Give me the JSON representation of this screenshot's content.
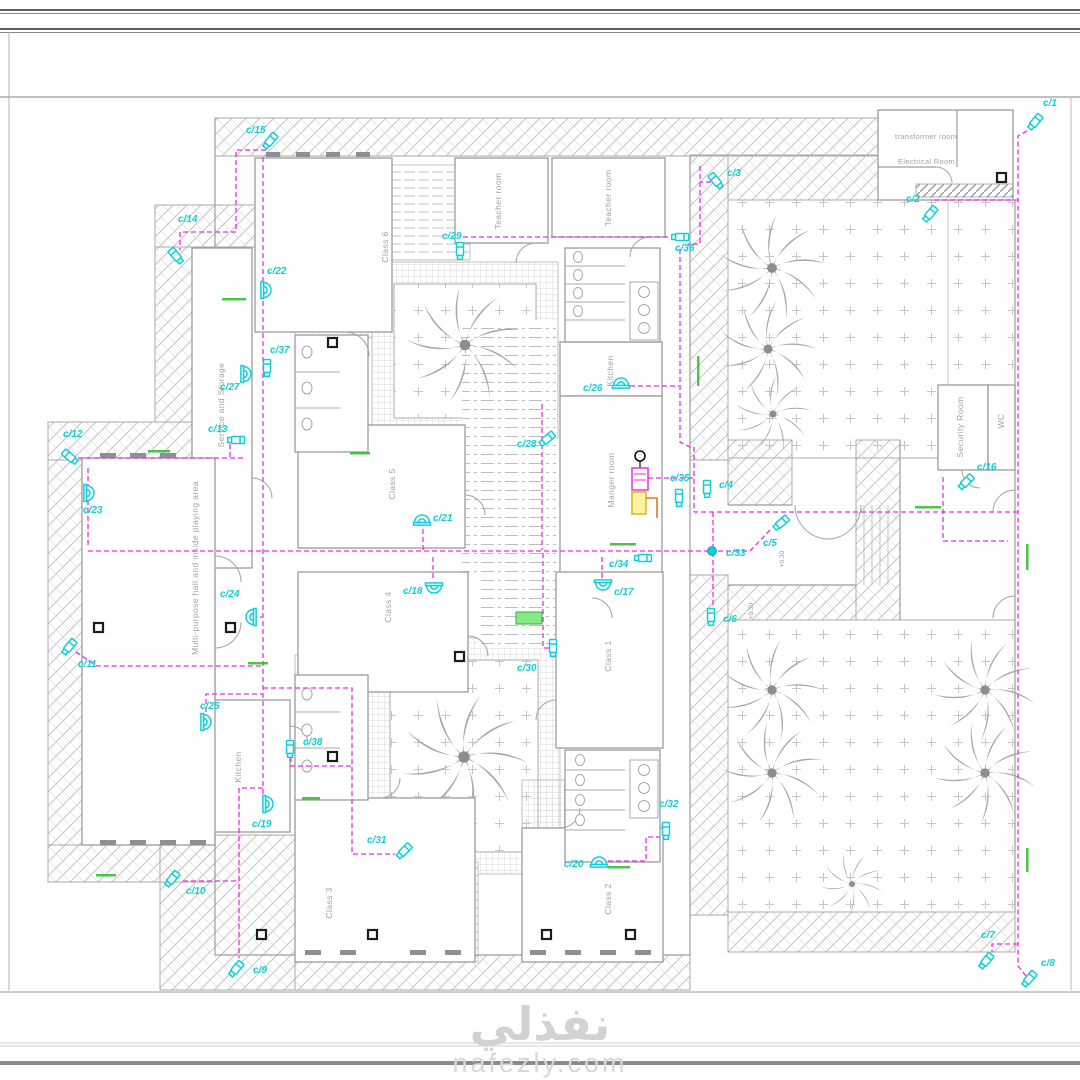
{
  "watermark": {
    "arabic": "نفذلي",
    "site": "nafezly.com"
  },
  "colors": {
    "wire": "#ee2bee",
    "camera": "#0fd0da",
    "green_tag": "#2eb82e",
    "wall": "#9c9c9c"
  },
  "levels": {
    "entrance_a": "+0.30",
    "entrance_b": "+0.30"
  },
  "rooms": {
    "transformer": "transformer room",
    "electrical": "Electrical Room",
    "class6": "Class 6",
    "teacher1": "Teacher room",
    "teacher2": "Teacher room",
    "service": "Service and Storage",
    "class5": "Class 5",
    "kitchen_top": "Kitchen",
    "manger": "Manger room",
    "class4": "Class 4",
    "class1": "Class 1",
    "class3": "Class 3",
    "class2": "Class 2",
    "kitchen_bottom": "Kitchen",
    "hall": "Multi-purpose hall and inside playing area",
    "security": "Security Room",
    "wc": "WC"
  },
  "cameras": [
    {
      "id": "c/1",
      "type": "b",
      "x": 1035,
      "y": 122,
      "rot": 40,
      "lx": 1043,
      "ly": 106
    },
    {
      "id": "c/2",
      "type": "b",
      "x": 930,
      "y": 214,
      "rot": 40,
      "lx": 906,
      "ly": 202
    },
    {
      "id": "c/3",
      "type": "b",
      "x": 716,
      "y": 181,
      "rot": -40,
      "lx": 727,
      "ly": 176
    },
    {
      "id": "c/4",
      "type": "b",
      "x": 707,
      "y": 489,
      "rot": 0,
      "lx": 719,
      "ly": 488
    },
    {
      "id": "c/5",
      "type": "b",
      "x": 781,
      "y": 523,
      "rot": 50,
      "lx": 763,
      "ly": 546
    },
    {
      "id": "c/6",
      "type": "b",
      "x": 711,
      "y": 617,
      "rot": 0,
      "lx": 723,
      "ly": 622
    },
    {
      "id": "c/7",
      "type": "b",
      "x": 986,
      "y": 961,
      "rot": 40,
      "lx": 981,
      "ly": 938
    },
    {
      "id": "c/8",
      "type": "b",
      "x": 1029,
      "y": 979,
      "rot": 40,
      "lx": 1041,
      "ly": 966
    },
    {
      "id": "c/9",
      "type": "b",
      "x": 236,
      "y": 969,
      "rot": 40,
      "lx": 253,
      "ly": 973
    },
    {
      "id": "c/10",
      "type": "b",
      "x": 172,
      "y": 879,
      "rot": 40,
      "lx": 186,
      "ly": 894
    },
    {
      "id": "c/11",
      "type": "b",
      "x": 69,
      "y": 647,
      "rot": 40,
      "lx": 78,
      "ly": 667
    },
    {
      "id": "c/12",
      "type": "b",
      "x": 70,
      "y": 457,
      "rot": -50,
      "lx": 63,
      "ly": 437
    },
    {
      "id": "c/13",
      "type": "b",
      "x": 236,
      "y": 440,
      "rot": 90,
      "lx": 208,
      "ly": 432
    },
    {
      "id": "c/14",
      "type": "b",
      "x": 176,
      "y": 256,
      "rot": -40,
      "lx": 178,
      "ly": 222
    },
    {
      "id": "c/15",
      "type": "b",
      "x": 270,
      "y": 141,
      "rot": 40,
      "lx": 246,
      "ly": 133
    },
    {
      "id": "c/16",
      "type": "b",
      "x": 966,
      "y": 482,
      "rot": 45,
      "lx": 977,
      "ly": 470
    },
    {
      "id": "c/17",
      "type": "d",
      "x": 603,
      "y": 585,
      "rot": 180,
      "lx": 614,
      "ly": 595
    },
    {
      "id": "c/18",
      "type": "d",
      "x": 434,
      "y": 588,
      "rot": 180,
      "lx": 403,
      "ly": 594
    },
    {
      "id": "c/19",
      "type": "d",
      "x": 268,
      "y": 804,
      "rot": 90,
      "lx": 252,
      "ly": 827
    },
    {
      "id": "c/20",
      "type": "d",
      "x": 599,
      "y": 862,
      "rot": 0,
      "lx": 564,
      "ly": 867
    },
    {
      "id": "c/21",
      "type": "d",
      "x": 422,
      "y": 520,
      "rot": 0,
      "lx": 433,
      "ly": 521
    },
    {
      "id": "c/22",
      "type": "d",
      "x": 266,
      "y": 290,
      "rot": 90,
      "lx": 267,
      "ly": 274
    },
    {
      "id": "c/23",
      "type": "d",
      "x": 89,
      "y": 493,
      "rot": 90,
      "lx": 83,
      "ly": 513
    },
    {
      "id": "c/24",
      "type": "d",
      "x": 251,
      "y": 617,
      "rot": -90,
      "lx": 220,
      "ly": 597
    },
    {
      "id": "c/25",
      "type": "d",
      "x": 206,
      "y": 722,
      "rot": 90,
      "lx": 200,
      "ly": 709
    },
    {
      "id": "c/26",
      "type": "d",
      "x": 621,
      "y": 383,
      "rot": 0,
      "lx": 583,
      "ly": 391
    },
    {
      "id": "c/27",
      "type": "d",
      "x": 246,
      "y": 374,
      "rot": 90,
      "lx": 220,
      "ly": 390
    },
    {
      "id": "c/28",
      "type": "b",
      "x": 547,
      "y": 439,
      "rot": 50,
      "lx": 517,
      "ly": 447
    },
    {
      "id": "c/29",
      "type": "b",
      "x": 460,
      "y": 251,
      "rot": 0,
      "lx": 442,
      "ly": 239
    },
    {
      "id": "c/30",
      "type": "b",
      "x": 553,
      "y": 648,
      "rot": 0,
      "lx": 517,
      "ly": 671
    },
    {
      "id": "c/31",
      "type": "b",
      "x": 404,
      "y": 851,
      "rot": 45,
      "lx": 367,
      "ly": 843
    },
    {
      "id": "c/32",
      "type": "b",
      "x": 666,
      "y": 831,
      "rot": 0,
      "lx": 659,
      "ly": 807
    },
    {
      "id": "c/33",
      "type": "j",
      "x": 712,
      "y": 551,
      "rot": 0,
      "lx": 726,
      "ly": 556
    },
    {
      "id": "c/34",
      "type": "b",
      "x": 643,
      "y": 558,
      "rot": 90,
      "lx": 609,
      "ly": 567
    },
    {
      "id": "c/35",
      "type": "b",
      "x": 679,
      "y": 498,
      "rot": 0,
      "lx": 670,
      "ly": 481
    },
    {
      "id": "c/36",
      "type": "b",
      "x": 680,
      "y": 237,
      "rot": 90,
      "lx": 675,
      "ly": 251
    },
    {
      "id": "c/37",
      "type": "b",
      "x": 267,
      "y": 368,
      "rot": 0,
      "lx": 270,
      "ly": 353
    },
    {
      "id": "c/38",
      "type": "b",
      "x": 290,
      "y": 749,
      "rot": 0,
      "lx": 303,
      "ly": 745
    }
  ]
}
